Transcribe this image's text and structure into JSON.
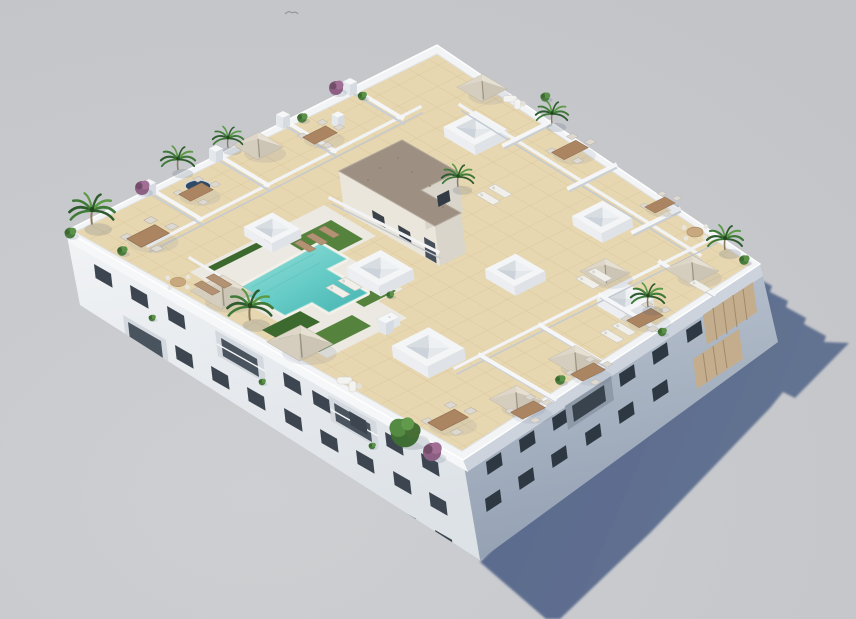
{
  "scene": {
    "kind": "3d-architectural-aerial-render",
    "description": "Bird's-eye 3D rendering of a white low-rise apartment building with a landscaped rooftop: turquoise T-shaped pool with lawn and white sun deck, beige parasols, wooden dining sets, sun loungers, palm trees and shrubs, white skylight boxes, an L-shaped stair core with brown gravel roof, private perimeter terraces divided by white walls, and a long blue-grey shadow cast on a neutral ground.",
    "objects": [
      "apartment-building",
      "rooftop-terrace",
      "swimming-pool",
      "sun-deck",
      "lawn-patches",
      "hedges",
      "parasols",
      "sun-loungers",
      "dining-sets",
      "round-tables",
      "sofa-set",
      "outdoor-kitchen",
      "jacuzzi-pond",
      "palm-trees",
      "green-tree",
      "shrubs",
      "purple-shrubs",
      "skylight-boxes",
      "stair-core",
      "partition-walls",
      "chimney-pillars",
      "balcony-slat-screens",
      "facade-windows",
      "cast-shadow",
      "bird"
    ],
    "counts": {
      "visible-floors": 4,
      "parasols": 8,
      "skylight-boxes": 7,
      "palm-trees": 8,
      "private-terraces": 12,
      "pool-count": 1
    },
    "colors": {
      "background": "#c7c9cd",
      "shadow": "#5a6b8c",
      "parapet": "#f3f4f6",
      "wallLit": "#eef0f3",
      "wallShade": "#b7c0cd",
      "tile": "#e7d7b1",
      "tileLine": "#d5c297",
      "deck": "#ebe9e2",
      "pool": "#6fcfca",
      "poolDeep": "#4fbcb9",
      "poolLight": "#93dcd6",
      "lawn": "#55833d",
      "lawnDark": "#3c6a2e",
      "coreRoof": "#9d9083",
      "coreWall": "#eae6db",
      "parasol": "#ded7c9",
      "parasolShade": "#ccc5b5",
      "wood": "#ab8562",
      "lounger": "#f0efea",
      "palm": "#3f7a38",
      "palmDark": "#2e5c2f",
      "palmLight": "#5c9a47",
      "purple": "#8d5f82",
      "window": "#3d4650",
      "windowShade": "#2e3842",
      "slat": "#c3ad8d",
      "bird": "#8e9196"
    }
  }
}
